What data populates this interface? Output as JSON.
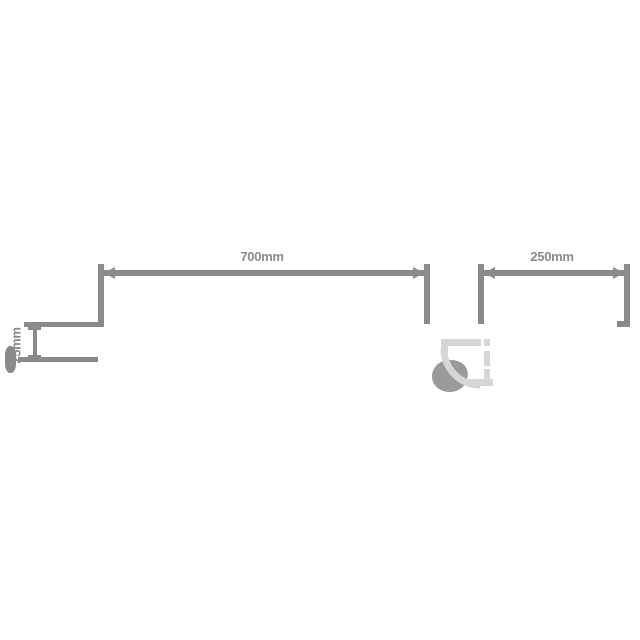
{
  "diagram": {
    "type": "technical-dimension-drawing",
    "dimensions": {
      "main_width": {
        "label": "700mm",
        "orientation": "horizontal"
      },
      "side_width": {
        "label": "250mm",
        "orientation": "horizontal"
      },
      "profile_depth": {
        "label": "25mm",
        "orientation": "vertical"
      }
    },
    "colors": {
      "background": "#ffffff",
      "line": "#8a8a8a",
      "light_panel": "#d6d6d6",
      "handle_blob": "#9a9a9a"
    }
  }
}
